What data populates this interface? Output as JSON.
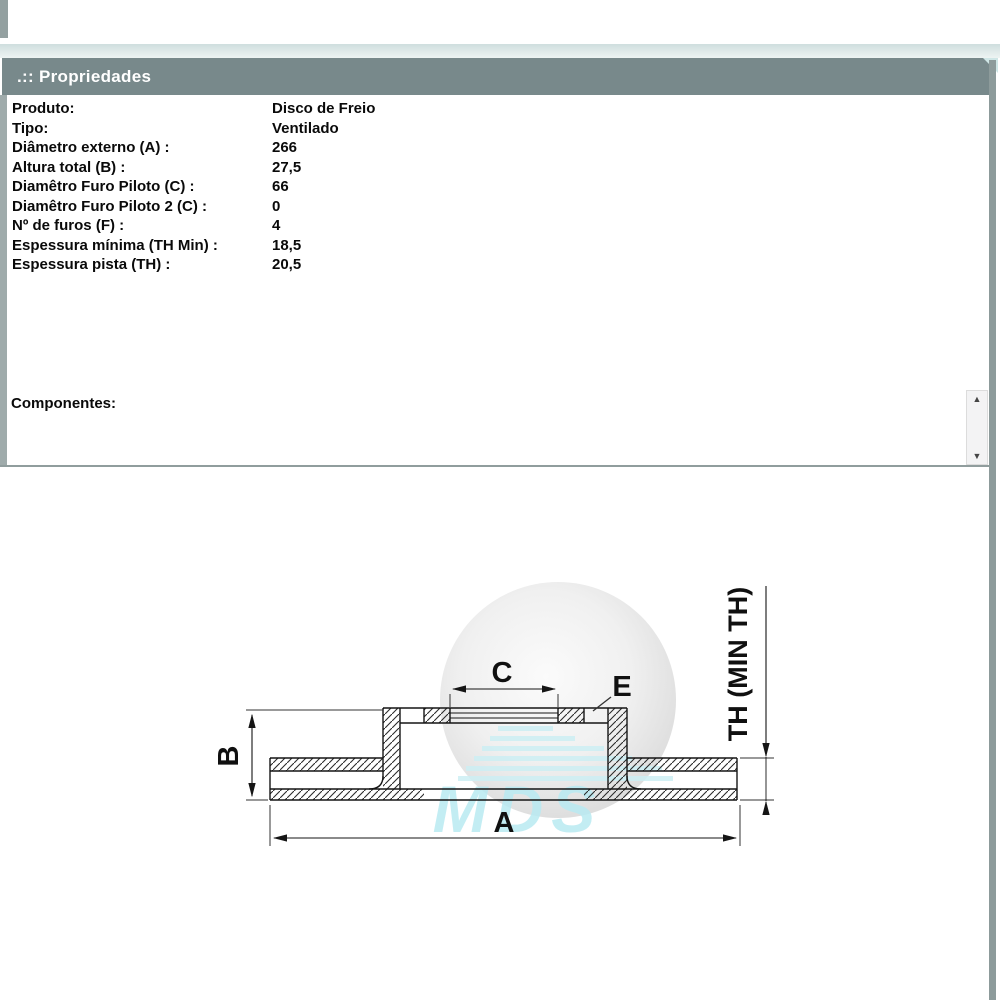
{
  "header": {
    "title": ".:: Propriedades"
  },
  "properties": [
    {
      "label": "Produto:",
      "value": "Disco de Freio"
    },
    {
      "label": "Tipo:",
      "value": "Ventilado"
    },
    {
      "label": "Diâmetro externo (A) :",
      "value": "266"
    },
    {
      "label": "Altura total (B) :",
      "value": "27,5"
    },
    {
      "label": "Diamêtro Furo Piloto (C) :",
      "value": "66"
    },
    {
      "label": "Diamêtro Furo Piloto 2 (C) :",
      "value": "0"
    },
    {
      "label": "Nº de furos (F) :",
      "value": "4"
    },
    {
      "label": "Espessura mínima (TH Min) :",
      "value": "18,5"
    },
    {
      "label": "Espessura pista (TH) :",
      "value": "20,5"
    }
  ],
  "components_label": "Componentes:",
  "scrollbar": {
    "up_icon": "▲",
    "down_icon": "▼"
  },
  "watermark": {
    "text": "MDS"
  },
  "drawing": {
    "labels": {
      "a": "A",
      "b": "B",
      "c": "C",
      "e": "E",
      "th": "TH (MIN TH)"
    }
  },
  "colors": {
    "header_bg": "#78898b",
    "accent_teal": "#cfe6e6",
    "watermark_cyan": "#b9eaf2",
    "line_black": "#151515"
  }
}
